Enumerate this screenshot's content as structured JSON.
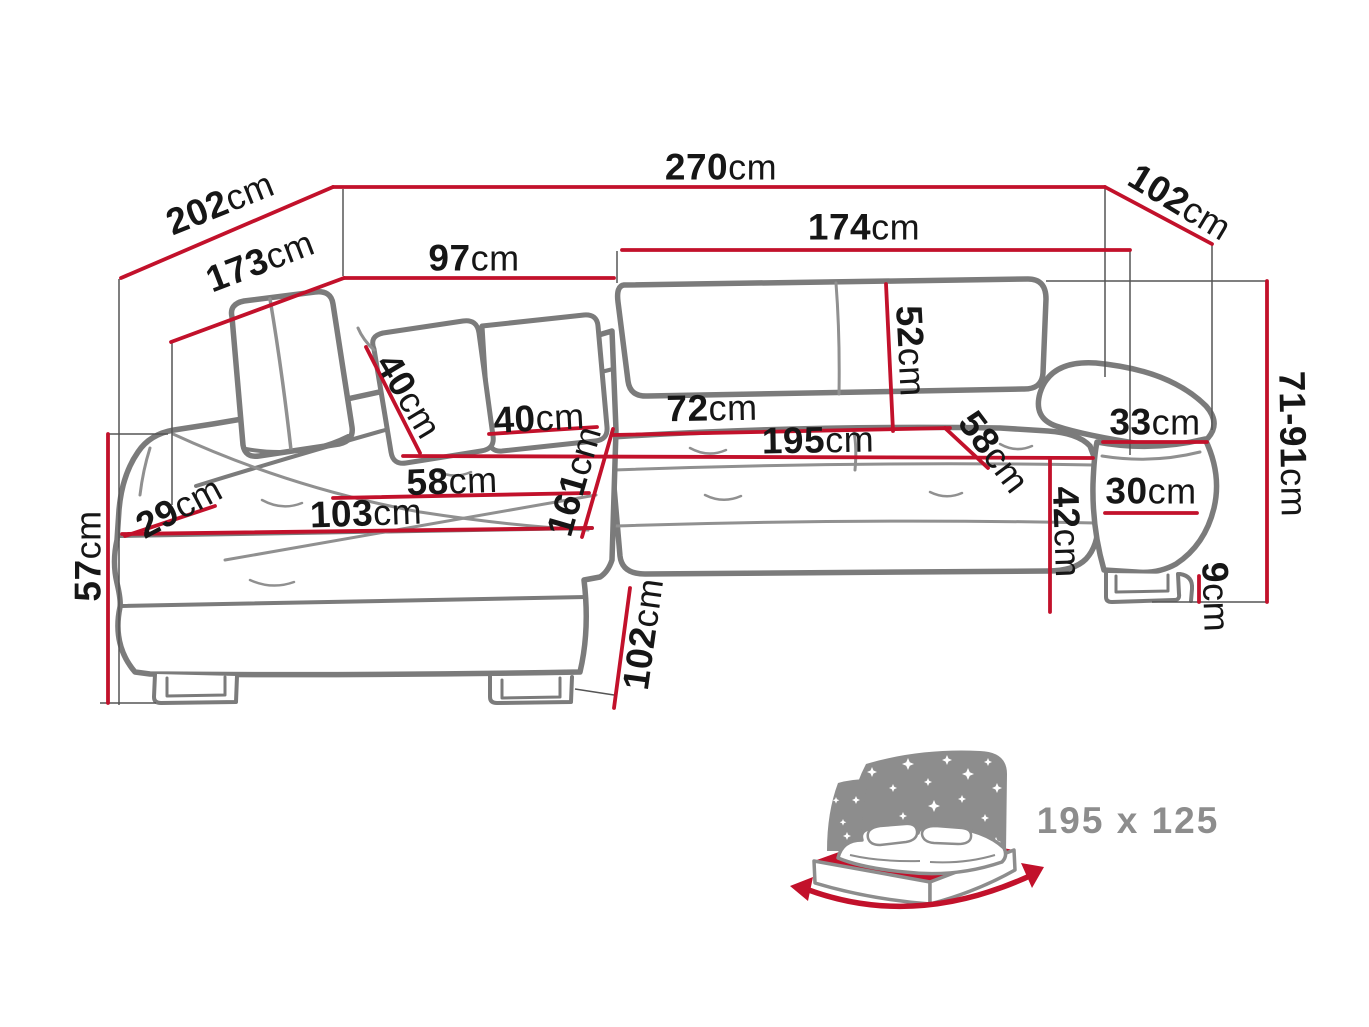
{
  "diagram": {
    "type": "corner-sofa-bed-dimension-diagram",
    "unit": "cm",
    "colors": {
      "dimension_red": "#c2112b",
      "outline_gray": "#7b7b7b",
      "seam_gray": "#909090",
      "guide_gray": "#555555",
      "label_black": "#161616",
      "icon_gray": "#8d8d8d"
    },
    "dimensions": [
      {
        "id": "depth-overall-left",
        "value": "202",
        "unit": "cm"
      },
      {
        "id": "width-overall",
        "value": "270",
        "unit": "cm"
      },
      {
        "id": "depth-overall-right",
        "value": "102",
        "unit": "cm"
      },
      {
        "id": "chaise-depth",
        "value": "173",
        "unit": "cm"
      },
      {
        "id": "chaise-back-width",
        "value": "97",
        "unit": "cm"
      },
      {
        "id": "seat-width",
        "value": "174",
        "unit": "cm"
      },
      {
        "id": "pillow-width",
        "value": "40",
        "unit": "cm"
      },
      {
        "id": "pillow-height",
        "value": "40",
        "unit": "cm"
      },
      {
        "id": "backrest-height",
        "value": "52",
        "unit": "cm"
      },
      {
        "id": "seat-depth",
        "value": "72",
        "unit": "cm"
      },
      {
        "id": "sleeping-length",
        "value": "195",
        "unit": "cm"
      },
      {
        "id": "seat-depth-diagonal",
        "value": "58",
        "unit": "cm"
      },
      {
        "id": "armrest-top-width",
        "value": "33",
        "unit": "cm"
      },
      {
        "id": "corner-front-edge",
        "value": "29",
        "unit": "cm"
      },
      {
        "id": "chaise-seat-width",
        "value": "58",
        "unit": "cm"
      },
      {
        "id": "chaise-front-length",
        "value": "103",
        "unit": "cm"
      },
      {
        "id": "chaise-side-length",
        "value": "161",
        "unit": "cm"
      },
      {
        "id": "seat-front-height",
        "value": "57",
        "unit": "cm"
      },
      {
        "id": "armrest-side-width",
        "value": "30",
        "unit": "cm"
      },
      {
        "id": "seat-height",
        "value": "42",
        "unit": "cm"
      },
      {
        "id": "backrest-height-range",
        "value": "71-91",
        "unit": "cm"
      },
      {
        "id": "leg-height",
        "value": "9",
        "unit": "cm"
      },
      {
        "id": "chaise-front-width",
        "value": "102",
        "unit": "cm"
      }
    ],
    "sleeping_area": {
      "label": "195 x 125"
    }
  }
}
